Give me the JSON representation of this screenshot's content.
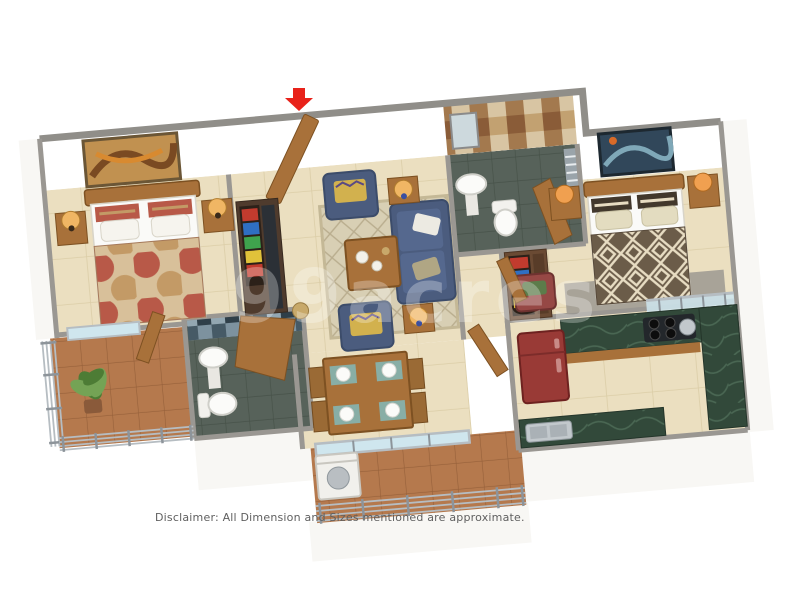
{
  "page": {
    "disclaimer": "Disclaimer: All Dimension and Sizes mentioned are approximate.",
    "watermark": "99acres"
  },
  "plan": {
    "type": "isometric-3d-floor-plan",
    "entrance_marker": "red-arrow-down",
    "rooms": [
      {
        "id": "bedroom-left",
        "items": [
          "double-bed",
          "patterned-duvet",
          "wall-art",
          "nightstand",
          "table-lamp",
          "balcony-window",
          "door"
        ]
      },
      {
        "id": "entry-hall",
        "items": [
          "entrance-door",
          "wardrobe-with-clothes",
          "tv-panel",
          "basket"
        ]
      },
      {
        "id": "living-room",
        "items": [
          "sofa-3-seater",
          "armchair",
          "armchair",
          "coffee-table",
          "rug",
          "side-table-lamp",
          "side-table-lamp",
          "cushions"
        ]
      },
      {
        "id": "bathroom-top",
        "items": [
          "checker-tile-wall",
          "pedestal-sink",
          "mirror",
          "toilet",
          "door",
          "window"
        ]
      },
      {
        "id": "bedroom-right",
        "items": [
          "double-bed",
          "geometric-duvet",
          "wall-art",
          "nightstand",
          "table-lamp",
          "wardrobe-with-clothes",
          "red-armchair",
          "rug",
          "glass-partition"
        ]
      },
      {
        "id": "kitchen",
        "items": [
          "refrigerator",
          "l-shaped-green-counter",
          "gas-stove",
          "pot",
          "steel-sink",
          "cabinets"
        ]
      },
      {
        "id": "dining",
        "items": [
          "dining-table",
          "chairs-4",
          "placemats-4",
          "plates-4",
          "glass-sliding-door"
        ]
      },
      {
        "id": "bathroom-bottom",
        "items": [
          "blue-checker-wall",
          "pedestal-sink",
          "toilet",
          "door"
        ]
      },
      {
        "id": "balcony-left",
        "items": [
          "terracotta-floor",
          "metal-railing",
          "potted-plant"
        ]
      },
      {
        "id": "balcony-bottom",
        "items": [
          "terracotta-floor",
          "metal-railing",
          "washing-machine"
        ]
      }
    ]
  },
  "palette": {
    "arrowRed": "#e8221a",
    "wallCap": "#908e89",
    "partition": "#9a9792",
    "wallFace": "#f8f7f4",
    "floorBeige": "#ebdfc0",
    "grout": "#dbcda7",
    "terracotta": "#b5794d",
    "terraLine": "#96603a",
    "bathFloor": "#57625a",
    "bathFloorLine": "#475249",
    "checkA": "#d8c5a3",
    "checkB": "#a3794e",
    "checkC": "#c2a171",
    "checkD": "#8a5c38",
    "blueA": "#7d929f",
    "blueB": "#465a66",
    "blueC": "#2f3f49",
    "blueD": "#93a7b2",
    "wood": "#a8713a",
    "woodDark": "#7d5122",
    "navy": "#4b5c7e",
    "navyDark": "#3c4c6a",
    "cushYellow": "#d2b14e",
    "rugBeige": "#d8cfb4",
    "rugLine": "#b9ad8e",
    "rugGray": "#a8a398",
    "duvetBase": "#d8c09a",
    "duvetRed": "#b85948",
    "duvetTan": "#c39a66",
    "geoBase": "#6b5c49",
    "geoCream": "#e7dcc2",
    "fridgeRed": "#993a36",
    "counterGreen": "#32493a",
    "counterVein": "#5d8068",
    "steel": "#c2c8cc",
    "chairRed": "#964845",
    "chairGreen": "#5c7c4a",
    "placemat": "#88aea6",
    "glass": "#cfe6ee",
    "rail": "#b6bdc2",
    "plantDark": "#4d7c35",
    "plantLight": "#74a355",
    "lampShade": "#f0b664",
    "lampBlue": "#3b4fa0",
    "whiteSoft": "#fafaf8"
  }
}
